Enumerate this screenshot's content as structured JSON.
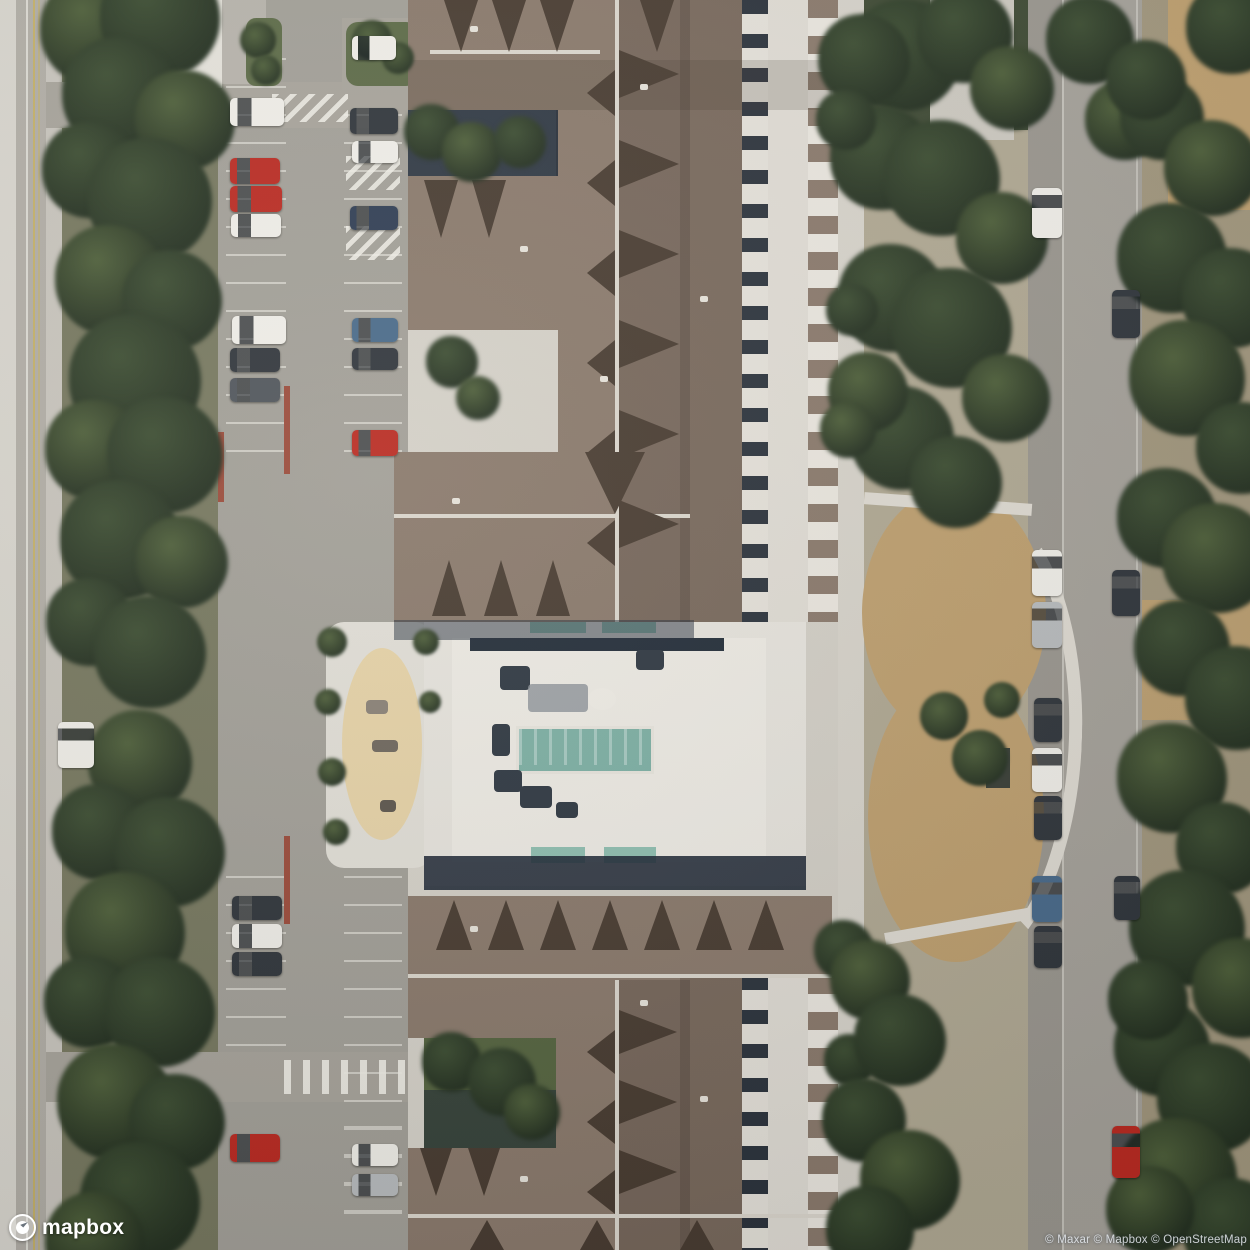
{
  "map": {
    "view_type": "satellite",
    "logo_text": "mapbox",
    "attribution_text": "© Maxar © Mapbox © OpenStreetMap"
  },
  "palette": {
    "pavement": "#d4d0c6",
    "road": "#a6a29a",
    "roof_brown": "#8c7a6b",
    "roof_dark": "#7a695b",
    "gable_shadow": "#4a3c30",
    "ridge_white": "#ddd8cd",
    "shadow_navy": "#222d3a",
    "tree_mid": "#3c4e31",
    "tree_dark": "#243120",
    "tree_light": "#4e6038",
    "grass_strip": "#77785e",
    "dry_grass": "#c1a06c",
    "sand": "#e9d4a5",
    "pool_teal": "#7bb2a5",
    "awning_teal": "#8ec1b1",
    "yellow_line": "#c9b257",
    "curb_red": "#a04a38",
    "car_white": "#f1efe9",
    "car_red": "#c2281e",
    "car_dark": "#30353b",
    "car_dark2": "#50555b",
    "car_darkblue": "#2e3d55",
    "car_blue": "#476a8c",
    "car_silver": "#b9bcbe"
  }
}
